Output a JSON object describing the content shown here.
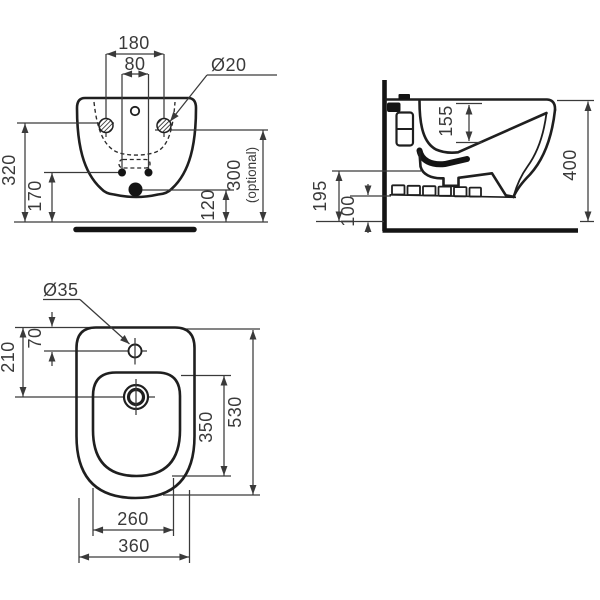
{
  "page": {
    "background": "#ffffff",
    "line_color": "#1f1f1f",
    "dim_color": "#3a3a3a"
  },
  "views": {
    "front": {
      "name": "front elevation",
      "dims": {
        "fixing_hole_spacing": "180",
        "supply_hole_spacing": "80",
        "fixing_hole_diameter": "Ø20",
        "fixing_height": "320",
        "supply_height": "170",
        "drain_height": "120",
        "optional_height": "300",
        "optional_note": "(optional)"
      }
    },
    "side": {
      "name": "side section",
      "dims": {
        "bowl_depth": "155",
        "overall_height": "400",
        "front_underside_height": "195",
        "rear_underside_height": "100"
      }
    },
    "top": {
      "name": "plan view",
      "dims": {
        "tap_hole_diameter": "Ø35",
        "tap_hole_offset": "70",
        "drain_offset": "210",
        "bowl_length": "350",
        "overall_length": "530",
        "bowl_width": "260",
        "overall_width": "360"
      }
    }
  }
}
